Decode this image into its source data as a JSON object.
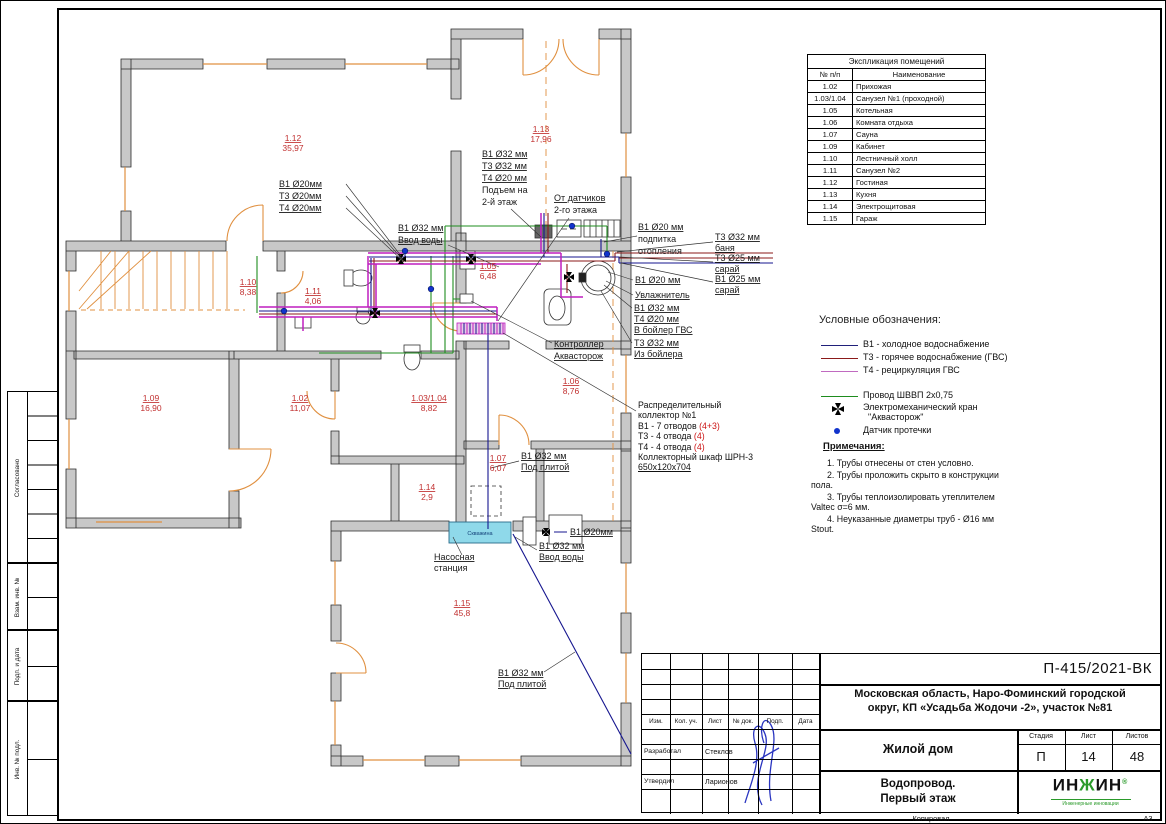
{
  "frame": {
    "copied": "Копировал",
    "format": "А3",
    "side": [
      "Согласовано",
      "Взам. инв. №",
      "Подп. и дата",
      "Инв. № подл."
    ]
  },
  "room_table": {
    "title": "Экспликация помещений",
    "col_num": "№ п/п",
    "col_name": "Наименование",
    "rows": [
      [
        "1.02",
        "Прихожая"
      ],
      [
        "1.03/1.04",
        "Санузел №1 (проходной)"
      ],
      [
        "1.05",
        "Котельная"
      ],
      [
        "1.06",
        "Комната отдыха"
      ],
      [
        "1.07",
        "Сауна"
      ],
      [
        "1.09",
        "Кабинет"
      ],
      [
        "1.10",
        "Лестничный холл"
      ],
      [
        "1.11",
        "Санузел №2"
      ],
      [
        "1.12",
        "Гостиная"
      ],
      [
        "1.13",
        "Кухня"
      ],
      [
        "1.14",
        "Электрощитовая"
      ],
      [
        "1.15",
        "Гараж"
      ]
    ]
  },
  "legend": {
    "title": "Условные обозначения:",
    "items": [
      {
        "label": "В1 - холодное водоснабжение",
        "color": "#20207a"
      },
      {
        "label": "Т3 - горячее водоснабжение (ГВС)",
        "color": "#8b1a1a"
      },
      {
        "label": "Т4 - рециркуляция ГВС",
        "color": "#c06ac0"
      }
    ],
    "wire_label": "Провод ШВВП 2х0,75",
    "wire_color": "#1e8c1e",
    "valve_line1": "Электромеханический кран",
    "valve_line2": "\"Аквасторож\"",
    "sensor_label": "Датчик протечки",
    "sensor_color": "#1133cc"
  },
  "notes": {
    "title": "Примечания:",
    "items": [
      "1.    Трубы отнесены от стен условно.",
      "2.    Трубы проложить скрыто в конструкции пола.",
      "3.    Трубы теплоизолировать утеплителем Valtec σ=6 мм.",
      "4.    Неуказанные диаметры труб - Ø16 мм Stout."
    ]
  },
  "collector": {
    "line1": "Распределительный",
    "line2": "коллектор №1",
    "b1": "В1 - 7 отводов ",
    "b1_n": "(4+3)",
    "t3": "Т3 - 4 отвода ",
    "t3_n": "(4)",
    "t4": "Т4 - 4 отвода ",
    "t4_n": "(4)",
    "cab1": "Коллекторный шкаф ШРН-3",
    "cab2": "650х120х704"
  },
  "plan_labels": [
    {
      "lines": [
        "В1 Ø20мм",
        "Т3 Ø20мм",
        "Т4 Ø20мм"
      ]
    },
    {
      "lines": [
        "В1 Ø32 мм",
        "Ввод воды"
      ]
    },
    {
      "lines": [
        "В1 Ø32 мм",
        "Т3 Ø32 мм",
        "Т4 Ø20 мм",
        "Подъем на",
        "2-й этаж"
      ]
    },
    {
      "lines": [
        "От датчиков",
        "2-го этажа"
      ]
    },
    {
      "lines": [
        "В1 Ø20 мм",
        "подпитка",
        "отопления"
      ]
    },
    {
      "lines": [
        "Т3 Ø32 мм",
        "баня"
      ]
    },
    {
      "lines": [
        "Т3 Ø25 мм",
        "сарай"
      ]
    },
    {
      "lines": [
        "В1 Ø25 мм",
        "сарай"
      ]
    },
    {
      "lines": [
        "В1 Ø20 мм"
      ]
    },
    {
      "lines": [
        "Увлажнитель"
      ]
    },
    {
      "lines": [
        "В1 Ø32 мм",
        "Т4 Ø20 мм",
        "В бойлер ГВС"
      ]
    },
    {
      "lines": [
        "Т3 Ø32 мм",
        "Из бойлера"
      ]
    },
    {
      "lines": [
        "Контроллер",
        "Аквасторож"
      ]
    },
    {
      "lines": [
        "В1 Ø32 мм",
        "Под плитой"
      ]
    },
    {
      "lines": [
        "Насосная",
        "станция"
      ]
    },
    {
      "lines": [
        "В1 Ø20мм"
      ]
    },
    {
      "lines": [
        "В1 Ø32 мм",
        "Ввод воды"
      ]
    },
    {
      "lines": [
        "В1 Ø32 мм",
        "Под плитой"
      ]
    },
    {
      "lines": [
        "Скважина"
      ]
    }
  ],
  "room_tags": [
    {
      "num": "1.12",
      "area": "35,97"
    },
    {
      "num": "1.13",
      "area": "17,96"
    },
    {
      "num": "1.10",
      "area": "8,38"
    },
    {
      "num": "1.11",
      "area": "4,06"
    },
    {
      "num": "1.05",
      "area": "6,48"
    },
    {
      "num": "1.06",
      "area": "8,76"
    },
    {
      "num": "1.09",
      "area": "16,90"
    },
    {
      "num": "1.02",
      "area": "11,07"
    },
    {
      "num": "1.03/1.04",
      "area": "8,82"
    },
    {
      "num": "1.07",
      "area": "6,07"
    },
    {
      "num": "1.14",
      "area": "2,9"
    },
    {
      "num": "1.15",
      "area": "45,8"
    }
  ],
  "title_block": {
    "doc_no": "П-415/2021-ВК",
    "address1": "Московская область, Наро-Фоминский городской",
    "address2": "округ, КП «Усадьба Жодочи -2», участок №81",
    "object": "Жилой дом",
    "title1": "Водопровод.",
    "title2": "Первый этаж",
    "stage_h": "Стадия",
    "sheet_h": "Лист",
    "sheets_h": "Листов",
    "stage": "П",
    "sheet": "14",
    "sheets": "48",
    "cols": [
      "Изм.",
      "Кол. уч.",
      "Лист",
      "№ док.",
      "Подп.",
      "Дата"
    ],
    "dev_label": "Разработал",
    "dev_name": "Стеклов",
    "app_label": "Утвердил",
    "app_name": "Ларионов",
    "logo1": "ИН",
    "logo2": "Ж",
    "logo3": "ИН",
    "logo_r": "®",
    "logo_sub": "Инженерные инновации"
  }
}
